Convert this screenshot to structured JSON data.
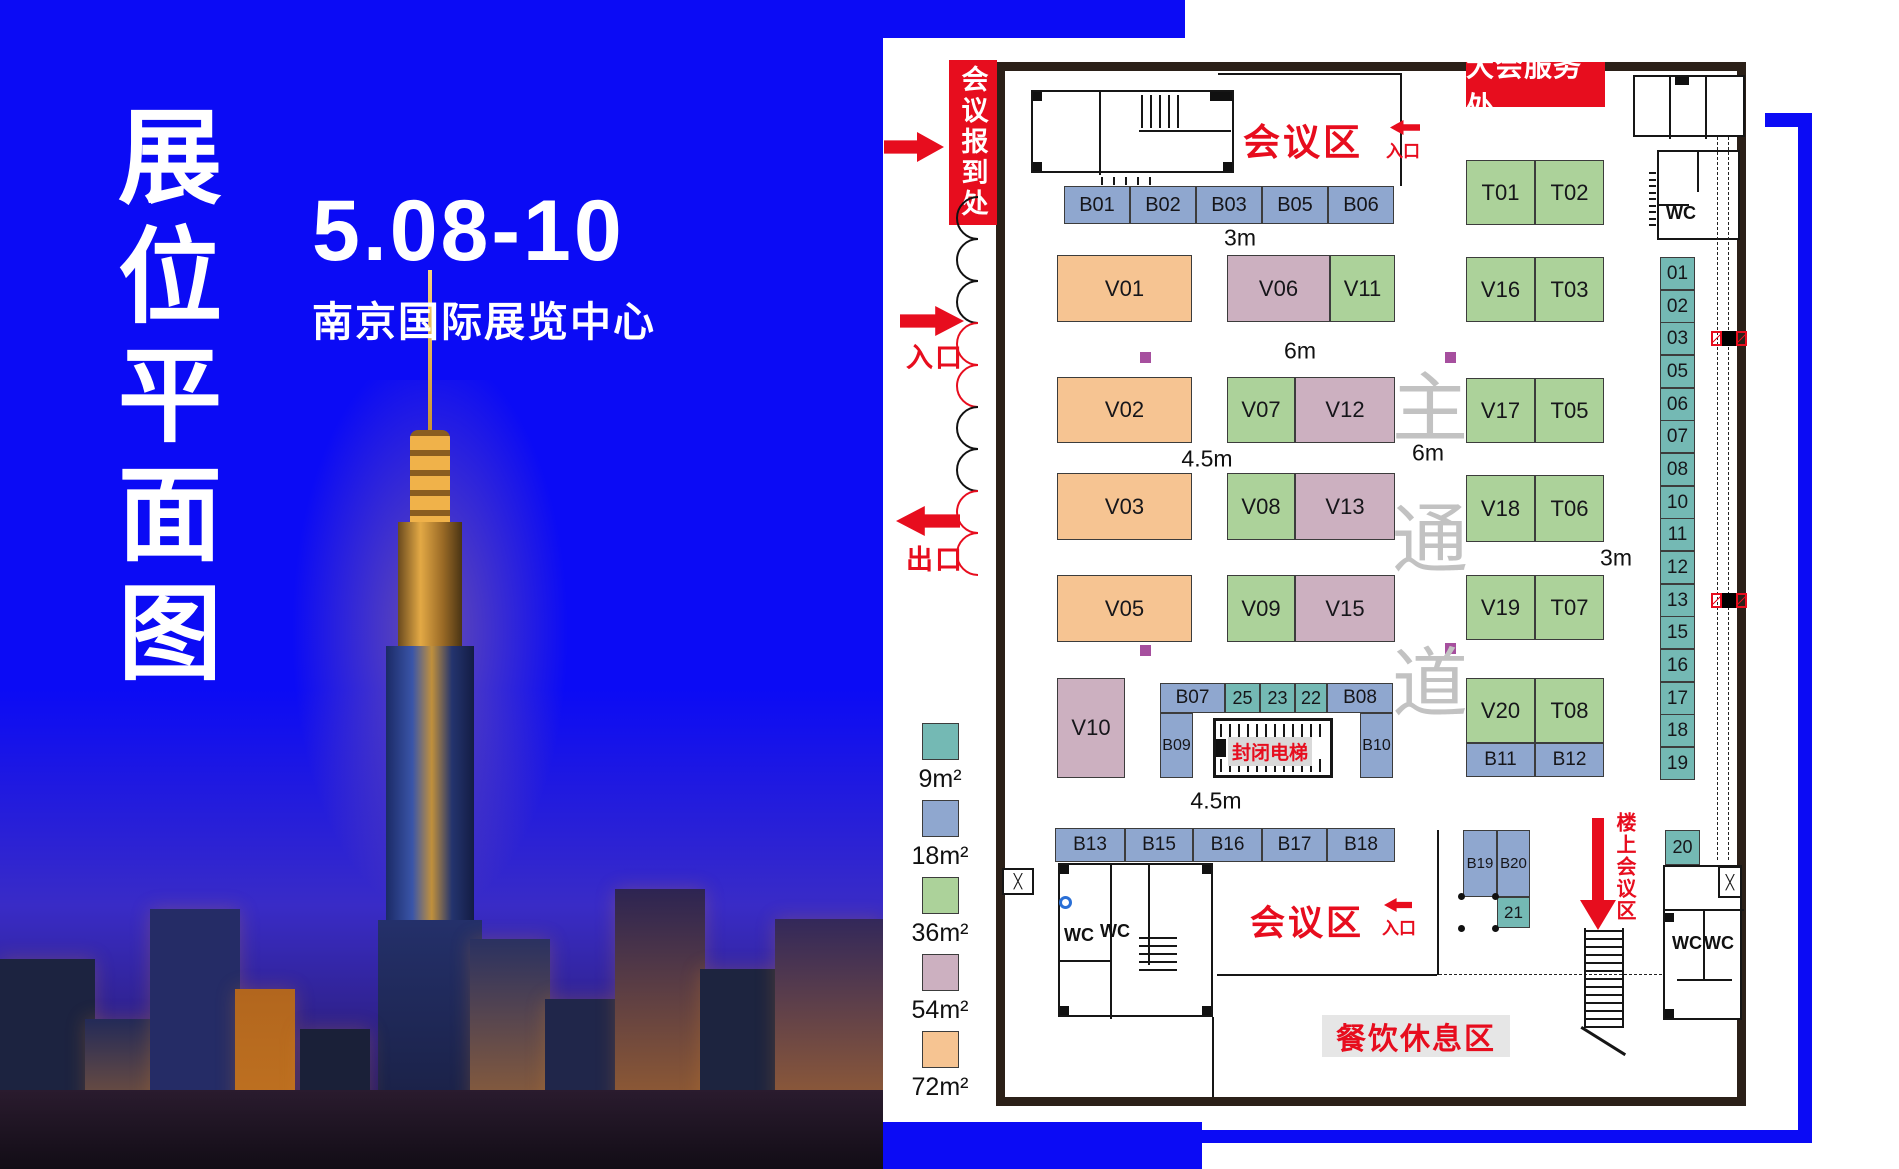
{
  "poster": {
    "title_chars": [
      "展",
      "位",
      "平",
      "面",
      "图"
    ],
    "date": "5.08-10",
    "venue": "南京国际展览中心"
  },
  "plan": {
    "labels": {
      "registration": "会议报到处",
      "service_desk": "大会服务处",
      "conference_top": "会议区",
      "conference_bottom": "会议区",
      "entrance": "入口",
      "exit": "出口",
      "closed_elevator": "封闭电梯",
      "dining": "餐饮休息区",
      "upstairs": "楼上会议区",
      "wc": "WC",
      "aisle_chars": [
        "主",
        "通",
        "道"
      ]
    },
    "dimensions": [
      {
        "text": "3m",
        "x": 1240,
        "y": 238
      },
      {
        "text": "6m",
        "x": 1300,
        "y": 351
      },
      {
        "text": "4.5m",
        "x": 1207,
        "y": 459
      },
      {
        "text": "6m",
        "x": 1428,
        "y": 453
      },
      {
        "text": "3m",
        "x": 1616,
        "y": 558
      },
      {
        "text": "4.5m",
        "x": 1216,
        "y": 801
      }
    ],
    "legend": [
      {
        "label": "9m²",
        "c": "s9"
      },
      {
        "label": "18m²",
        "c": "s18"
      },
      {
        "label": "36m²",
        "c": "s36"
      },
      {
        "label": "54m²",
        "c": "s54"
      },
      {
        "label": "72m²",
        "c": "s72"
      }
    ],
    "booths": [
      {
        "label": "B01",
        "x": 1064,
        "y": 186,
        "w": 66,
        "h": 38,
        "c": "s18",
        "fs": 20
      },
      {
        "label": "B02",
        "x": 1130,
        "y": 186,
        "w": 66,
        "h": 38,
        "c": "s18",
        "fs": 20
      },
      {
        "label": "B03",
        "x": 1196,
        "y": 186,
        "w": 66,
        "h": 38,
        "c": "s18",
        "fs": 20
      },
      {
        "label": "B05",
        "x": 1262,
        "y": 186,
        "w": 66,
        "h": 38,
        "c": "s18",
        "fs": 20
      },
      {
        "label": "B06",
        "x": 1328,
        "y": 186,
        "w": 66,
        "h": 38,
        "c": "s18",
        "fs": 20
      },
      {
        "label": "V01",
        "x": 1057,
        "y": 255,
        "w": 135,
        "h": 67,
        "c": "s72",
        "fs": 22
      },
      {
        "label": "V02",
        "x": 1057,
        "y": 377,
        "w": 135,
        "h": 66,
        "c": "s72",
        "fs": 22
      },
      {
        "label": "V03",
        "x": 1057,
        "y": 473,
        "w": 135,
        "h": 67,
        "c": "s72",
        "fs": 22
      },
      {
        "label": "V05",
        "x": 1057,
        "y": 575,
        "w": 135,
        "h": 67,
        "c": "s72",
        "fs": 22
      },
      {
        "label": "V10",
        "x": 1057,
        "y": 678,
        "w": 68,
        "h": 100,
        "c": "s54",
        "fs": 22
      },
      {
        "label": "V06",
        "x": 1227,
        "y": 255,
        "w": 103,
        "h": 67,
        "c": "s54",
        "fs": 22
      },
      {
        "label": "V11",
        "x": 1330,
        "y": 255,
        "w": 65,
        "h": 67,
        "c": "s36",
        "fs": 22
      },
      {
        "label": "V07",
        "x": 1227,
        "y": 377,
        "w": 68,
        "h": 66,
        "c": "s36",
        "fs": 22
      },
      {
        "label": "V12",
        "x": 1295,
        "y": 377,
        "w": 100,
        "h": 66,
        "c": "s54",
        "fs": 22
      },
      {
        "label": "V08",
        "x": 1227,
        "y": 473,
        "w": 68,
        "h": 67,
        "c": "s36",
        "fs": 22
      },
      {
        "label": "V13",
        "x": 1295,
        "y": 473,
        "w": 100,
        "h": 67,
        "c": "s54",
        "fs": 22
      },
      {
        "label": "V09",
        "x": 1227,
        "y": 575,
        "w": 68,
        "h": 67,
        "c": "s36",
        "fs": 22
      },
      {
        "label": "V15",
        "x": 1295,
        "y": 575,
        "w": 100,
        "h": 67,
        "c": "s54",
        "fs": 22
      },
      {
        "label": "T01",
        "x": 1466,
        "y": 160,
        "w": 69,
        "h": 65,
        "c": "s36",
        "fs": 22
      },
      {
        "label": "T02",
        "x": 1535,
        "y": 160,
        "w": 69,
        "h": 65,
        "c": "s36",
        "fs": 22
      },
      {
        "label": "V16",
        "x": 1466,
        "y": 257,
        "w": 69,
        "h": 65,
        "c": "s36",
        "fs": 22
      },
      {
        "label": "T03",
        "x": 1535,
        "y": 257,
        "w": 69,
        "h": 65,
        "c": "s36",
        "fs": 22
      },
      {
        "label": "V17",
        "x": 1466,
        "y": 378,
        "w": 69,
        "h": 65,
        "c": "s36",
        "fs": 22
      },
      {
        "label": "T05",
        "x": 1535,
        "y": 378,
        "w": 69,
        "h": 65,
        "c": "s36",
        "fs": 22
      },
      {
        "label": "V18",
        "x": 1466,
        "y": 475,
        "w": 69,
        "h": 67,
        "c": "s36",
        "fs": 22
      },
      {
        "label": "T06",
        "x": 1535,
        "y": 475,
        "w": 69,
        "h": 67,
        "c": "s36",
        "fs": 22
      },
      {
        "label": "V19",
        "x": 1466,
        "y": 575,
        "w": 69,
        "h": 65,
        "c": "s36",
        "fs": 22
      },
      {
        "label": "T07",
        "x": 1535,
        "y": 575,
        "w": 69,
        "h": 65,
        "c": "s36",
        "fs": 22
      },
      {
        "label": "V20",
        "x": 1466,
        "y": 678,
        "w": 69,
        "h": 65,
        "c": "s36",
        "fs": 22
      },
      {
        "label": "T08",
        "x": 1535,
        "y": 678,
        "w": 69,
        "h": 65,
        "c": "s36",
        "fs": 22
      },
      {
        "label": "B11",
        "x": 1466,
        "y": 743,
        "w": 69,
        "h": 34,
        "c": "s18",
        "fs": 19
      },
      {
        "label": "B12",
        "x": 1535,
        "y": 743,
        "w": 69,
        "h": 34,
        "c": "s18",
        "fs": 19
      },
      {
        "label": "B07",
        "x": 1160,
        "y": 683,
        "w": 65,
        "h": 30,
        "c": "s18",
        "fs": 19
      },
      {
        "label": "25",
        "x": 1225,
        "y": 683,
        "w": 35,
        "h": 30,
        "c": "s9",
        "fs": 18
      },
      {
        "label": "23",
        "x": 1260,
        "y": 683,
        "w": 35,
        "h": 30,
        "c": "s9",
        "fs": 18
      },
      {
        "label": "22",
        "x": 1295,
        "y": 683,
        "w": 32,
        "h": 30,
        "c": "s9",
        "fs": 18
      },
      {
        "label": "B08",
        "x": 1327,
        "y": 683,
        "w": 66,
        "h": 30,
        "c": "s18",
        "fs": 19
      },
      {
        "label": "B09",
        "x": 1160,
        "y": 713,
        "w": 33,
        "h": 65,
        "c": "s18",
        "fs": 16
      },
      {
        "label": "B10",
        "x": 1360,
        "y": 713,
        "w": 33,
        "h": 65,
        "c": "s18",
        "fs": 16
      },
      {
        "label": "B13",
        "x": 1055,
        "y": 828,
        "w": 70,
        "h": 34,
        "c": "s18",
        "fs": 19
      },
      {
        "label": "B15",
        "x": 1125,
        "y": 828,
        "w": 68,
        "h": 34,
        "c": "s18",
        "fs": 19
      },
      {
        "label": "B16",
        "x": 1193,
        "y": 828,
        "w": 69,
        "h": 34,
        "c": "s18",
        "fs": 19
      },
      {
        "label": "B17",
        "x": 1262,
        "y": 828,
        "w": 65,
        "h": 34,
        "c": "s18",
        "fs": 19
      },
      {
        "label": "B18",
        "x": 1327,
        "y": 828,
        "w": 68,
        "h": 34,
        "c": "s18",
        "fs": 19
      },
      {
        "label": "B19",
        "x": 1463,
        "y": 830,
        "w": 34,
        "h": 67,
        "c": "s18",
        "fs": 15
      },
      {
        "label": "B20",
        "x": 1497,
        "y": 830,
        "w": 33,
        "h": 67,
        "c": "s18",
        "fs": 15
      },
      {
        "label": "21",
        "x": 1497,
        "y": 897,
        "w": 33,
        "h": 31,
        "c": "s9",
        "fs": 17
      },
      {
        "label": "20",
        "x": 1665,
        "y": 830,
        "w": 35,
        "h": 35,
        "c": "s9",
        "fs": 18
      },
      {
        "label": "01",
        "x": 1660,
        "y": 257,
        "w": 35,
        "h": 33,
        "c": "s9",
        "fs": 19
      },
      {
        "label": "02",
        "x": 1660,
        "y": 290,
        "w": 35,
        "h": 33,
        "c": "s9",
        "fs": 19
      },
      {
        "label": "03",
        "x": 1660,
        "y": 322,
        "w": 35,
        "h": 33,
        "c": "s9",
        "fs": 19
      },
      {
        "label": "05",
        "x": 1660,
        "y": 355,
        "w": 35,
        "h": 33,
        "c": "s9",
        "fs": 19
      },
      {
        "label": "06",
        "x": 1660,
        "y": 388,
        "w": 35,
        "h": 33,
        "c": "s9",
        "fs": 19
      },
      {
        "label": "07",
        "x": 1660,
        "y": 420,
        "w": 35,
        "h": 33,
        "c": "s9",
        "fs": 19
      },
      {
        "label": "08",
        "x": 1660,
        "y": 453,
        "w": 35,
        "h": 33,
        "c": "s9",
        "fs": 19
      },
      {
        "label": "10",
        "x": 1660,
        "y": 486,
        "w": 35,
        "h": 33,
        "c": "s9",
        "fs": 19
      },
      {
        "label": "11",
        "x": 1660,
        "y": 518,
        "w": 35,
        "h": 33,
        "c": "s9",
        "fs": 19
      },
      {
        "label": "12",
        "x": 1660,
        "y": 551,
        "w": 35,
        "h": 33,
        "c": "s9",
        "fs": 19
      },
      {
        "label": "13",
        "x": 1660,
        "y": 584,
        "w": 35,
        "h": 33,
        "c": "s9",
        "fs": 19
      },
      {
        "label": "15",
        "x": 1660,
        "y": 616,
        "w": 35,
        "h": 33,
        "c": "s9",
        "fs": 19
      },
      {
        "label": "16",
        "x": 1660,
        "y": 649,
        "w": 35,
        "h": 33,
        "c": "s9",
        "fs": 19
      },
      {
        "label": "17",
        "x": 1660,
        "y": 682,
        "w": 35,
        "h": 33,
        "c": "s9",
        "fs": 19
      },
      {
        "label": "18",
        "x": 1660,
        "y": 714,
        "w": 35,
        "h": 33,
        "c": "s9",
        "fs": 19
      },
      {
        "label": "19",
        "x": 1660,
        "y": 747,
        "w": 35,
        "h": 33,
        "c": "s9",
        "fs": 19
      }
    ]
  },
  "colors": {
    "blue": "#0b0bf5",
    "red": "#e70d1e",
    "wall": "#2b2018",
    "size9": "#74b9b4",
    "size18": "#8fa7cf",
    "size36": "#acd29a",
    "size54": "#ccb0c0",
    "size72": "#f6c492"
  }
}
